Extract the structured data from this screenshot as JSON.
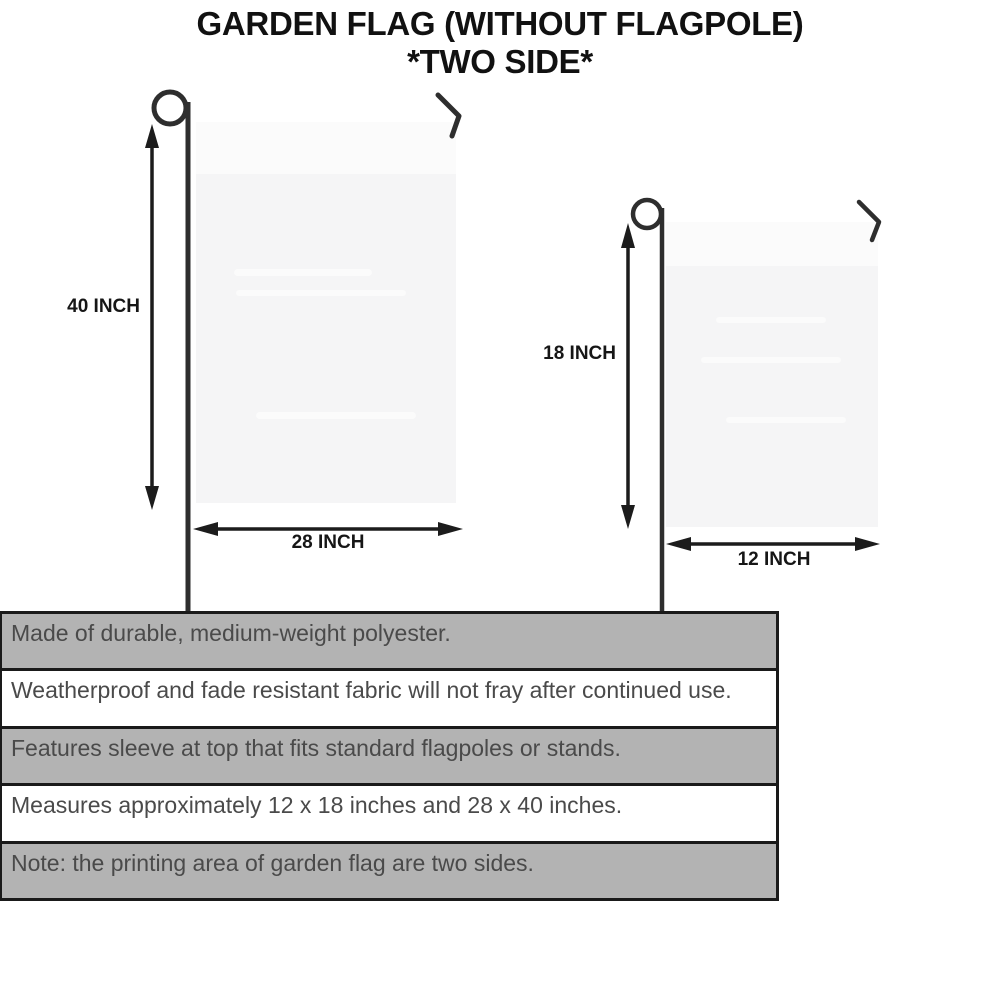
{
  "title": {
    "line1": "GARDEN FLAG (WITHOUT FLAGPOLE)",
    "line2": "*TWO SIDE*"
  },
  "diagram": {
    "large_flag": {
      "height_label": "40 INCH",
      "width_label": "28 INCH"
    },
    "small_flag": {
      "height_label": "18 INCH",
      "width_label": "12 INCH"
    }
  },
  "features": [
    {
      "text": "Made of durable, medium-weight polyester."
    },
    {
      "text": "Weatherproof and fade resistant fabric will not fray after continued use."
    },
    {
      "text": "Features sleeve at top that fits standard flagpoles or stands."
    },
    {
      "text": "Measures approximately 12 x 18 inches and 28 x 40 inches."
    },
    {
      "text": "Note: the printing area of garden flag are two sides."
    }
  ],
  "colors": {
    "title_color": "#111111",
    "dim_text": "#161616",
    "feature_text": "#4a4a4a",
    "row_shaded": "#b3b3b3",
    "row_plain": "#ffffff",
    "table_border": "#1a1a1a",
    "flag_fill": "#f5f5f6",
    "pole_color": "#2e2e2e",
    "arrow_color": "#1c1c1c"
  }
}
